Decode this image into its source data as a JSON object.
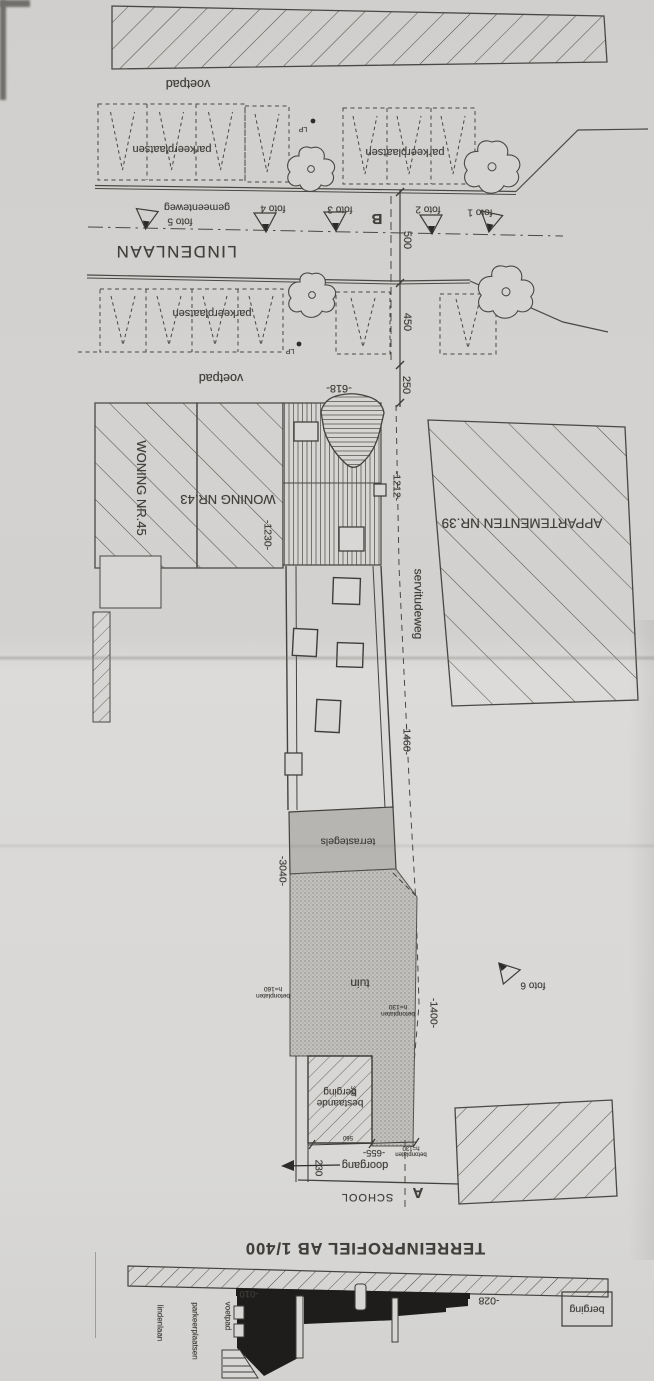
{
  "sheet": {
    "title": "TERREINPROFIEL AB  1/400"
  },
  "plan": {
    "voetpad_north": "voetpad",
    "voetpad_south": "voetpad",
    "parking_north_left": "parkeerplaatsen",
    "parking_north_right": "parkeerplaatsen",
    "parking_south": "parkeerplaatsen",
    "lamp_post_1": "LP",
    "lamp_post_2": "LP",
    "street_name": "LINDENLAAN",
    "street_type": "gemeenteweg",
    "section_b": "B",
    "section_a": "A",
    "dim_500": "500",
    "dim_450": "450",
    "dim_250": "250",
    "dim_618": "-618-",
    "foto_1": "foto 1",
    "foto_2": "foto 2",
    "foto_3": "foto 3",
    "foto_4": "foto 4",
    "foto_5": "foto 5",
    "foto_6": "foto 6",
    "woning_45": "WONING NR.45",
    "woning_43": "WONING NR.43",
    "dim_1230": "-1230-",
    "dim_1212": "-1212-",
    "appartementen_39": "APPARTEMENTEN NR.39",
    "servitudeweg": "servitudeweg",
    "dim_1460": "-1460-",
    "dim_1400": "-1400-",
    "terrastegels": "terrastegels",
    "dim_3040": "-3040-",
    "tuin": "tuin",
    "note_betonplaten_160_l1": "betonplaten",
    "note_betonplaten_160_l2": "h=160",
    "note_betonplaten_130a_l1": "betonplaten",
    "note_betonplaten_130a_l2": "h=130",
    "note_betonplaten_130b_l1": "betonplaten",
    "note_betonplaten_130b_l2": "h=130",
    "shed_l1": "bestaande",
    "shed_l2": "berging",
    "dim_300": "300",
    "dim_560": "560",
    "dim_655": "-655-",
    "doorgang": "doorgang",
    "dim_230": "230",
    "school": "SCHOOL"
  },
  "profile": {
    "lindenlaan": "lindenlaan",
    "parkeerplaatsen": "parkeerplaatsen",
    "voetpad": "voetpad",
    "level_minus_010": "-010",
    "level_minus_028": "-028",
    "berging": "berging"
  },
  "colors": {
    "paper": "#d6d4d2",
    "ink": "#45433f",
    "silhouette": "#1e1d1b",
    "terrace_fill": "#b7b5b2",
    "garden_fill": "#c3c1be"
  }
}
